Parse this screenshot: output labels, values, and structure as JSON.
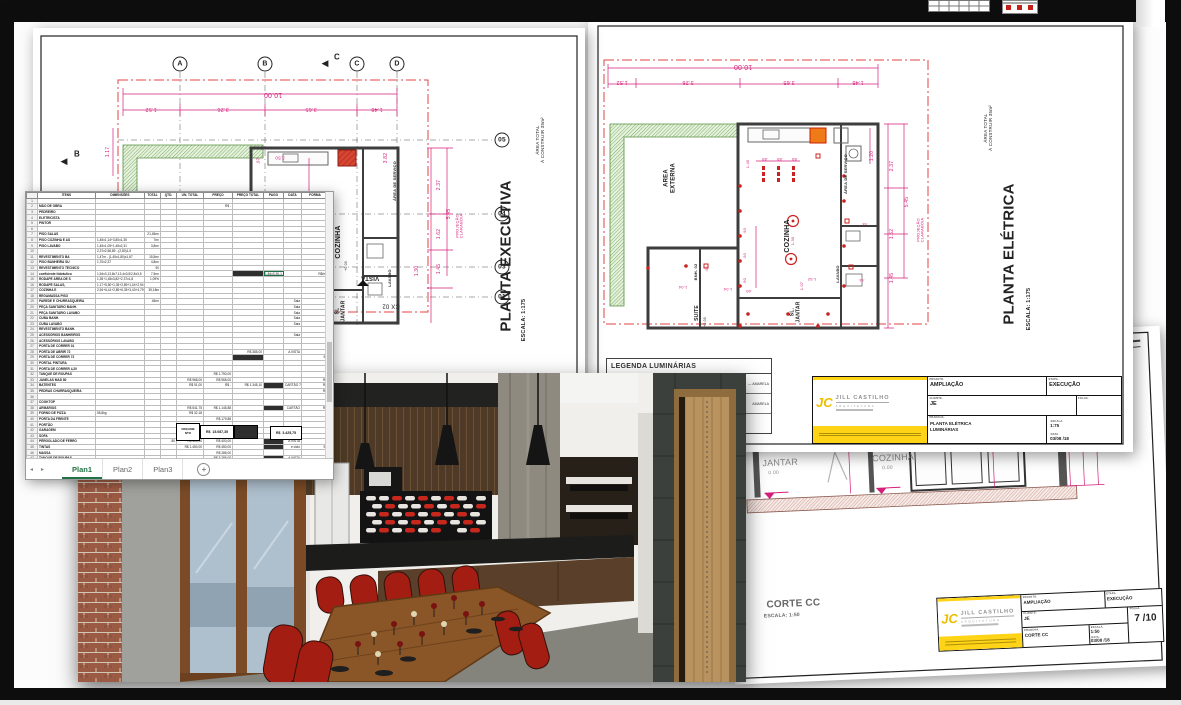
{
  "pink": "#d41f7a",
  "exec": {
    "labels": [
      {
        "x": 240,
        "y": 66,
        "t": "10.00",
        "r": 180,
        "s": 7,
        "c": "#d41f7a"
      },
      {
        "x": 118,
        "y": 81,
        "t": "1.52",
        "r": 180,
        "s": 5.5,
        "c": "#d41f7a"
      },
      {
        "x": 190,
        "y": 81,
        "t": "3.26",
        "r": 180,
        "s": 5.5,
        "c": "#d41f7a"
      },
      {
        "x": 278,
        "y": 81,
        "t": "3.65",
        "r": 180,
        "s": 5.5,
        "c": "#d41f7a"
      },
      {
        "x": 344,
        "y": 81,
        "t": "1.48",
        "r": 180,
        "s": 5.5,
        "c": "#d41f7a"
      },
      {
        "x": 76,
        "y": 124,
        "t": "1.17",
        "r": -90,
        "s": 5,
        "c": "#d41f7a"
      },
      {
        "x": 147,
        "y": 36,
        "t": "A",
        "b": 1,
        "s": 7
      },
      {
        "x": 232,
        "y": 36,
        "t": "B",
        "b": 1,
        "s": 7
      },
      {
        "x": 324,
        "y": 36,
        "t": "C",
        "b": 1,
        "s": 7
      },
      {
        "x": 364,
        "y": 36,
        "t": "D",
        "b": 1,
        "s": 7
      },
      {
        "x": 292,
        "y": 35,
        "t": "◀",
        "s": 9
      },
      {
        "x": 304,
        "y": 30,
        "t": "C",
        "s": 8,
        "w": 1
      },
      {
        "x": 31,
        "y": 133,
        "t": "◀",
        "s": 9
      },
      {
        "x": 44,
        "y": 127,
        "t": "B",
        "s": 8,
        "w": 1
      },
      {
        "x": 469,
        "y": 112,
        "t": "05",
        "b": 1,
        "s": 6.5
      },
      {
        "x": 469,
        "y": 186,
        "t": "04",
        "b": 1,
        "s": 6.5
      },
      {
        "x": 469,
        "y": 239,
        "t": "03",
        "b": 1,
        "s": 6.5
      },
      {
        "x": 469,
        "y": 269,
        "t": "01",
        "b": 1,
        "s": 6.5
      },
      {
        "x": 306,
        "y": 214,
        "t": "COZINHA",
        "r": -90,
        "s": 7,
        "w": 1
      },
      {
        "x": 314,
        "y": 238,
        "t": "+0.00",
        "r": -90,
        "s": 3.5
      },
      {
        "x": 308,
        "y": 283,
        "t": "SL\nJANTAR",
        "r": -90,
        "s": 5,
        "w": 1
      },
      {
        "x": 357,
        "y": 250,
        "t": "LAVABO",
        "r": -90,
        "s": 4,
        "w": 1
      },
      {
        "x": 362,
        "y": 153,
        "t": "ÁREA DE SERVIÇO",
        "r": -90,
        "s": 4,
        "w": 1
      },
      {
        "x": 427,
        "y": 198,
        "t": "PROJEÇÃO\nCLARABÓIA",
        "r": -90,
        "s": 4,
        "c": "#d41f7a"
      },
      {
        "x": 358,
        "y": 277,
        "t": "CX 02",
        "r": 180,
        "s": 6
      },
      {
        "x": 337,
        "y": 249,
        "t": "VISTA",
        "r": 180,
        "s": 6,
        "w": 1
      },
      {
        "x": 354,
        "y": 130,
        "t": "3.82",
        "r": -90,
        "s": 5,
        "c": "#d41f7a"
      },
      {
        "x": 407,
        "y": 157,
        "t": "2.37",
        "r": -90,
        "s": 5,
        "c": "#d41f7a"
      },
      {
        "x": 417,
        "y": 186,
        "t": "5.45",
        "r": -90,
        "s": 5,
        "c": "#d41f7a"
      },
      {
        "x": 407,
        "y": 206,
        "t": "1.62",
        "r": -90,
        "s": 5,
        "c": "#d41f7a"
      },
      {
        "x": 407,
        "y": 241,
        "t": "1.45",
        "r": -90,
        "s": 5,
        "c": "#d41f7a"
      },
      {
        "x": 385,
        "y": 243,
        "t": "1.30",
        "r": -90,
        "s": 5,
        "c": "#d41f7a"
      },
      {
        "x": 283,
        "y": 168,
        "t": "2.30",
        "r": -90,
        "s": 5,
        "c": "#d41f7a"
      },
      {
        "x": 252,
        "y": 207,
        "t": "2.42",
        "r": -90,
        "s": 5,
        "c": "#d41f7a"
      },
      {
        "x": 225,
        "y": 133,
        "t": ".97",
        "r": -90,
        "s": 4.5,
        "c": "#d41f7a"
      },
      {
        "x": 247,
        "y": 130,
        "t": "3.50",
        "r": 180,
        "s": 4.5,
        "c": "#d41f7a"
      },
      {
        "x": 289,
        "y": 249,
        "t": "2.70",
        "r": 180,
        "s": 4.5,
        "c": "#d41f7a"
      },
      {
        "x": 247,
        "y": 276,
        "t": "3.09",
        "r": 180,
        "s": 4.5,
        "c": "#d41f7a"
      },
      {
        "x": 228,
        "y": 286,
        "t": ".60",
        "r": 180,
        "s": 4.5,
        "c": "#d41f7a"
      },
      {
        "x": 507,
        "y": 112,
        "t": "ÁREA TOTAL\nÀ CONSTRUIR 35m²",
        "r": -90,
        "s": 4.5
      },
      {
        "x": 474,
        "y": 228,
        "t": "PLANTA EXECUTIVA",
        "r": -90,
        "s": 15,
        "w": 1
      },
      {
        "x": 491,
        "y": 292,
        "t": "ESCALA: 1:175",
        "r": -90,
        "s": 5.5,
        "w": 1
      }
    ]
  },
  "elec": {
    "legend_title": "LEGENDA LUMINÁRIAS",
    "legend_rows": [
      "— AMARELA",
      "AMARELA",
      ""
    ],
    "labels": [
      {
        "x": 155,
        "y": 50,
        "t": "10.00",
        "r": 180,
        "s": 7,
        "c": "#d41f7a"
      },
      {
        "x": 34,
        "y": 66,
        "t": "1.52",
        "r": 180,
        "s": 5.5,
        "c": "#d41f7a"
      },
      {
        "x": 100,
        "y": 66,
        "t": "3.26",
        "r": 180,
        "s": 5.5,
        "c": "#d41f7a"
      },
      {
        "x": 201,
        "y": 66,
        "t": "3.65",
        "r": 180,
        "s": 5.5,
        "c": "#d41f7a"
      },
      {
        "x": 270,
        "y": 66,
        "t": "1.48",
        "r": 180,
        "s": 5.5,
        "c": "#d41f7a"
      },
      {
        "x": 82,
        "y": 162,
        "t": "AREA\nEXTERNA",
        "r": -90,
        "s": 6,
        "w": 1
      },
      {
        "x": 200,
        "y": 220,
        "t": "COZINHA",
        "r": -90,
        "s": 7,
        "w": 1
      },
      {
        "x": 258,
        "y": 158,
        "t": "ÁREA DE SERVIÇO",
        "r": -90,
        "s": 4,
        "w": 1
      },
      {
        "x": 250,
        "y": 258,
        "t": "LAVABO",
        "r": -90,
        "s": 4,
        "w": 1
      },
      {
        "x": 208,
        "y": 296,
        "t": "SL.\nJANTAR",
        "r": -90,
        "s": 5,
        "w": 1
      },
      {
        "x": 110,
        "y": 297,
        "t": "SUITE",
        "r": -90,
        "s": 5,
        "w": 1
      },
      {
        "x": 108,
        "y": 256,
        "t": "BNH. 02",
        "r": -90,
        "s": 4,
        "w": 1
      },
      {
        "x": 333,
        "y": 214,
        "t": "PROJEÇÃO\nCLARABÓIA",
        "r": -90,
        "s": 4,
        "c": "#d41f7a"
      },
      {
        "x": 305,
        "y": 150,
        "t": "2.37",
        "r": -90,
        "s": 5,
        "c": "#d41f7a"
      },
      {
        "x": 320,
        "y": 186,
        "t": "5.45",
        "r": -90,
        "s": 5,
        "c": "#d41f7a"
      },
      {
        "x": 305,
        "y": 218,
        "t": "1.62",
        "r": -90,
        "s": 5,
        "c": "#d41f7a"
      },
      {
        "x": 305,
        "y": 262,
        "t": "1.45",
        "r": -90,
        "s": 5,
        "c": "#d41f7a"
      },
      {
        "x": 285,
        "y": 140,
        "t": "1.20",
        "r": -90,
        "s": 5,
        "c": "#d41f7a"
      },
      {
        "x": 160,
        "y": 148,
        "t": "1.45",
        "r": -90,
        "s": 4,
        "c": "#d41f7a"
      },
      {
        "x": 177,
        "y": 143,
        "t": ".89",
        "r": 180,
        "s": 4,
        "c": "#d41f7a"
      },
      {
        "x": 192,
        "y": 143,
        "t": ".89",
        "r": 180,
        "s": 4,
        "c": "#d41f7a"
      },
      {
        "x": 207,
        "y": 143,
        "t": ".89",
        "r": 180,
        "s": 4,
        "c": "#d41f7a"
      },
      {
        "x": 157,
        "y": 215,
        "t": ".90",
        "r": -90,
        "s": 4,
        "c": "#d41f7a"
      },
      {
        "x": 157,
        "y": 240,
        "t": ".90",
        "r": -90,
        "s": 4,
        "c": "#d41f7a"
      },
      {
        "x": 157,
        "y": 265,
        "t": ".90",
        "r": -90,
        "s": 4,
        "c": "#d41f7a"
      },
      {
        "x": 205,
        "y": 225,
        "t": "1.30",
        "r": -90,
        "s": 4,
        "c": "#d41f7a"
      },
      {
        "x": 214,
        "y": 270,
        "t": "1.07",
        "r": -90,
        "s": 4,
        "c": "#d41f7a"
      },
      {
        "x": 224,
        "y": 263,
        "t": "1.52",
        "r": 180,
        "s": 4,
        "c": "#d41f7a"
      },
      {
        "x": 95,
        "y": 271,
        "t": "1.04",
        "r": 180,
        "s": 4,
        "c": "#d41f7a"
      },
      {
        "x": 140,
        "y": 273,
        "t": "1.04",
        "r": 180,
        "s": 4,
        "c": "#d41f7a"
      },
      {
        "x": 161,
        "y": 275,
        "t": ".60",
        "r": 180,
        "s": 4,
        "c": "#d41f7a"
      },
      {
        "x": 120,
        "y": 253,
        "t": ".65",
        "r": -90,
        "s": 3.5,
        "c": "#d41f7a"
      },
      {
        "x": 277,
        "y": 207,
        "t": ".64",
        "r": 180,
        "s": 3.5,
        "c": "#d41f7a"
      },
      {
        "x": 274,
        "y": 263,
        "t": ".64",
        "r": 180,
        "s": 3.5,
        "c": "#d41f7a"
      },
      {
        "x": 118,
        "y": 306,
        "t": "+0.00",
        "r": -90,
        "s": 3.5
      },
      {
        "x": 400,
        "y": 112,
        "t": "ÁREA TOTAL\nÀ CONSTRUIR 35m²",
        "r": -90,
        "s": 4.5
      },
      {
        "x": 422,
        "y": 238,
        "t": "PLANTA ELÉTRICA",
        "r": -90,
        "s": 15,
        "w": 1
      },
      {
        "x": 441,
        "y": 293,
        "t": "ESCALA: 1:175",
        "r": -90,
        "s": 5.5,
        "w": 1
      }
    ]
  },
  "corte": {
    "labels": [
      {
        "x": 55,
        "y": 120,
        "t": "JANTAR",
        "s": 9,
        "c": "#8a8a8a"
      },
      {
        "x": 48,
        "y": 131,
        "t": "0.00",
        "s": 5,
        "c": "#8a8a8a"
      },
      {
        "x": 168,
        "y": 120,
        "t": "COZINHA",
        "s": 9,
        "c": "#8a8a8a"
      },
      {
        "x": 162,
        "y": 131,
        "t": "0.00",
        "s": 5,
        "c": "#8a8a8a"
      },
      {
        "x": 128,
        "y": 95,
        "t": "2.70",
        "r": -90,
        "s": 5,
        "c": "#d41f7a"
      },
      {
        "x": 272,
        "y": 95,
        "t": "2.70",
        "r": -90,
        "s": 5,
        "c": "#d41f7a"
      },
      {
        "x": 296,
        "y": 98,
        "t": "3.03",
        "r": -90,
        "s": 5,
        "c": "#d41f7a"
      },
      {
        "x": 348,
        "y": 105,
        "t": "2.70",
        "r": -90,
        "s": 5,
        "c": "#d41f7a"
      },
      {
        "x": 362,
        "y": 88,
        "t": "3.74",
        "r": -90,
        "s": 5,
        "c": "#d41f7a"
      },
      {
        "x": 376,
        "y": 82,
        "t": "4.00",
        "r": -90,
        "s": 5,
        "c": "#d41f7a"
      },
      {
        "x": 348,
        "y": 38,
        "t": ".74",
        "r": -90,
        "s": 4,
        "c": "#d41f7a"
      },
      {
        "x": 348,
        "y": 55,
        "t": ".30",
        "r": -90,
        "s": 4,
        "c": "#d41f7a"
      },
      {
        "x": 272,
        "y": 44,
        "t": "forro de gesso",
        "s": 3.5,
        "c": "#999999"
      },
      {
        "x": 62,
        "y": 262,
        "t": "CORTE CC",
        "s": 10,
        "w": 1,
        "c": "#666666"
      },
      {
        "x": 50,
        "y": 274,
        "t": "ESCALA: 1:50",
        "s": 5,
        "w": 1,
        "c": "#666666"
      }
    ]
  },
  "tb_labels": {
    "projeto": "PROJETO.",
    "etapa": "ETAPA.",
    "cliente": "CLIENTE.",
    "folha": "FOLHA.",
    "prancha": "PRANCHA.",
    "escala": "ESCALA.",
    "data": "DATA."
  },
  "logo": {
    "monogram": "JC",
    "company": "JILL CASTILHO",
    "tagline": "ARQUITETURA"
  },
  "elec_tb": {
    "projeto": "AMPLIAÇÃO",
    "etapa": "EXECUÇÃO",
    "cliente": "JE",
    "folha": "",
    "prancha1": "PLANTA  ELÉTRICA",
    "prancha2": "LUMINÁRIAS",
    "escala": "1:75",
    "data": "03/08 /18"
  },
  "corte_tb": {
    "projeto": "AMPLIAÇÃO",
    "etapa": "EXECUÇÃO",
    "cliente": "JE",
    "folha": "7 /10",
    "prancha1": "CORTE CC",
    "prancha2": "",
    "escala": "1:50",
    "data": "03/08 /18"
  },
  "spreadsheet": {
    "headers": [
      "ITENS",
      "DIMENSÕES",
      "TOTAL",
      "QTD.",
      "UN. TOTAL",
      "PREÇO",
      "PREÇO TOTAL",
      "PAGO",
      "DATA",
      "FORMA",
      ""
    ],
    "col_widths": [
      55,
      46,
      13,
      13,
      24,
      26,
      28,
      17,
      15,
      24,
      26
    ],
    "selected": [
      13,
      7
    ],
    "rows": [
      [],
      [
        "MÃO DE OBRA",
        "",
        "",
        "",
        "",
        "R$      -"
      ],
      [
        "PEDREIRO"
      ],
      [
        "ELETRICISTA"
      ],
      [
        "PINTOR"
      ],
      [],
      [
        "PISO SALAS",
        "",
        "21,45m²"
      ],
      [
        "PISO COZINHA E AS",
        "1,45x1,14+3,80x1,35",
        "7m²"
      ],
      [
        "PISO LAVABO",
        "1,45x1,05+1,45x2,31",
        "3,8m²"
      ],
      [
        "",
        "2,37x2,58,89 - (2,80)1,5",
        ""
      ],
      [
        "REVESTIMENTO BA",
        "1,47m - (1,45x1,80)x1,67",
        "15,5m²"
      ],
      [
        "PISO BANHEIRA SU",
        "1,70x2,37",
        "4,8m²"
      ],
      [
        "REVESTIMENTO TÉCNICO",
        "",
        "90"
      ],
      [
        "coeficiente hidráulico",
        "1,54x3,13,8x7,13,4x3,5/2,8x3,5",
        "7,5m²",
        "",
        "",
        "",
        "########",
        "1.84x3.26-1.84x7,25",
        "",
        "R$/m²"
      ],
      [
        "RODAPÉ ÁREA DE S",
        "1,35+1,45x3,82+2,37x1,8",
        "1,09%"
      ],
      [
        "RODAPÉ  SALAS,",
        "1,17+5,50+1,35+2,89+1,04+2,94",
        ""
      ],
      [
        "COZINHA E",
        "2,94+6,41+2,89+6,35+3,43+4,79+6,5",
        "35,18m"
      ],
      [
        "REGAMASSA PISO"
      ],
      [
        "PAREDE E CHURRASQUEIRA",
        "",
        "45m²",
        "",
        "",
        "",
        "",
        "",
        "Sala"
      ],
      [
        "PEÇA SANITARIO BANH.",
        "",
        "",
        "",
        "",
        "",
        "",
        "",
        "Sala"
      ],
      [
        "PEÇA SANITARIO LAVABO",
        "",
        "",
        "",
        "",
        "",
        "",
        "",
        "Sala"
      ],
      [
        "CUBA BANH.",
        "",
        "",
        "",
        "",
        "",
        "",
        "",
        "Sala"
      ],
      [
        "CUBA LAVABO",
        "",
        "",
        "",
        "",
        "",
        "",
        "",
        "Sala"
      ],
      [
        "REVESTIMENTO BANH."
      ],
      [
        "ACESSÓRIOS BANHEIROS",
        "",
        "",
        "",
        "",
        "",
        "",
        "",
        "Sala"
      ],
      [
        "ACESSÓRIOS LAVABO"
      ],
      [
        "PORTA DE CORRER 01"
      ],
      [
        "PORTA DE ABRIR 72",
        "",
        "",
        "",
        "",
        "",
        "R$   385,00",
        "",
        "A VISTA"
      ],
      [
        "PORTA DE CORRER 72",
        "",
        "",
        "",
        "",
        "",
        "########",
        "",
        "",
        "92"
      ],
      [
        "PORTAL PINTURA"
      ],
      [
        "PORTA DE CORRER 4,20"
      ],
      [
        "TANQUE DE ROUPAS",
        "",
        "",
        "",
        "",
        "R$  1.790,00"
      ],
      [
        "JANELAS MAD 80",
        "",
        "",
        "",
        "R$ 968,00",
        "R$   968,00",
        "",
        "",
        "",
        "R$"
      ],
      [
        "BATENTES",
        "",
        "",
        "",
        "R$  91,00",
        "R$      -",
        "R$ 1.345,10",
        "########",
        "CARTÃO 7X90",
        "R$"
      ],
      [
        "PEDRAS CHURRASQUEIRA",
        "",
        "",
        "",
        "",
        "",
        "",
        "",
        "",
        "R$"
      ],
      [],
      [
        "COOKTOP"
      ],
      [
        "ARMÁRIOS",
        "",
        "",
        "",
        "R$ 541,75",
        "R$ 1.145,88",
        "",
        "########",
        "CARTÃO",
        "R$"
      ],
      [
        "FORNO DE PIZZA",
        "55,8kg",
        "",
        "",
        "R$  32,18"
      ],
      [
        "PORTA DA FRENTE",
        "",
        "",
        "",
        "",
        "R$   179,88"
      ],
      [
        "PORTÃO"
      ],
      [
        "GARAGEM"
      ],
      [
        "SOFA",
        "",
        "",
        "",
        "",
        "R$  2.979,20",
        "",
        "",
        "Sala"
      ],
      [
        "PÉRGOLADO DE FERRO",
        "",
        "",
        "80",
        "R$  400,00",
        "R$   400,00",
        "",
        "########",
        "A VISTA"
      ],
      [
        "TINTAS",
        "",
        "",
        "",
        "R$ 1.450,00",
        "R$   450,00",
        "",
        "########",
        "e ciclo",
        "92"
      ],
      [
        "MASSA",
        "",
        "",
        "",
        "",
        "R$   285,00"
      ],
      [
        "TANQUE DE ROUPAS",
        "",
        "",
        "",
        "",
        "R$ 5.285,00",
        "",
        "########",
        "A VISTA"
      ],
      [
        "TORNEIRA TANQUE",
        "",
        "",
        "",
        "R$  265,00",
        "R$   265,00",
        "",
        "########",
        "CARTÃO 2X"
      ],
      [
        "",
        "",
        "",
        "",
        "",
        "R$   107,75"
      ],
      [
        "",
        "",
        "",
        "",
        "R$  530,00",
        "R$   235,00",
        "",
        "########",
        "A VISTA"
      ],
      [],
      [],
      [],
      [],
      [],
      []
    ],
    "totals": {
      "label": "ORÇAME\nNTO",
      "value1": "R$  15.087,35",
      "hash": "########",
      "value2": "R$  3.425,75"
    },
    "tabs": [
      "Plan1",
      "Plan2",
      "Plan3"
    ],
    "active_tab": "Plan1"
  }
}
